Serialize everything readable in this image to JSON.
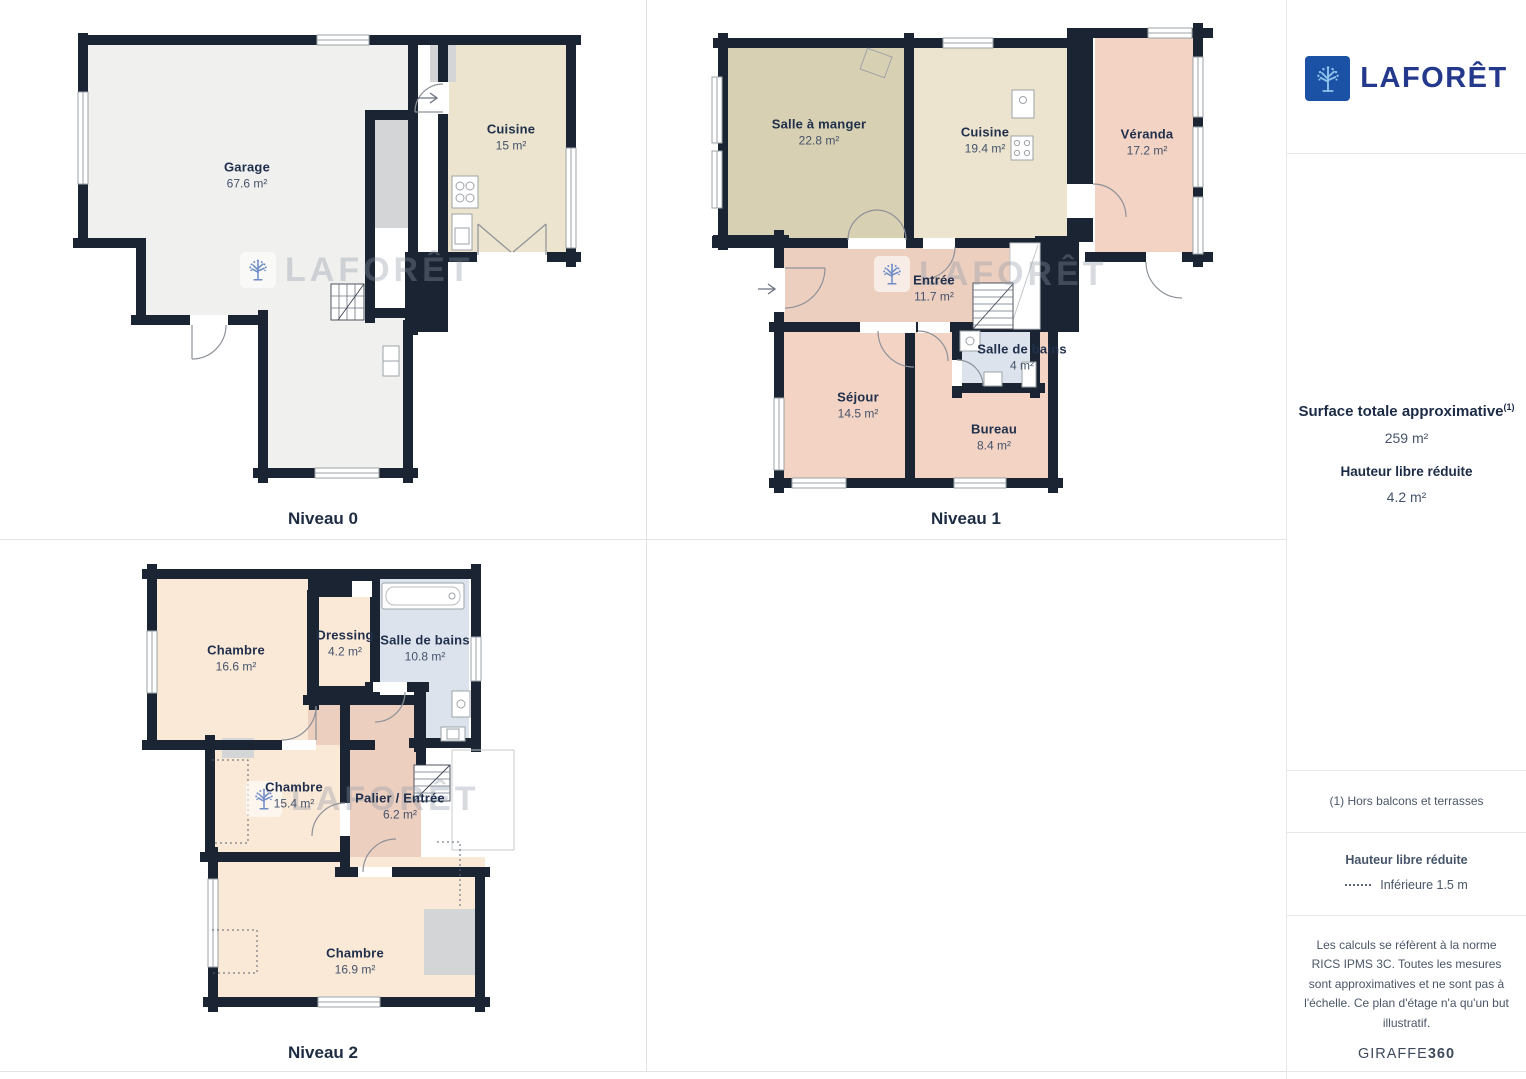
{
  "brand": {
    "name": "LAFORÊT"
  },
  "watermark": {
    "text": "LAFORÊT"
  },
  "levels": [
    {
      "name": "Niveau 0",
      "rooms": [
        {
          "label": "Garage",
          "area": "67.6 m²"
        },
        {
          "label": "Cuisine",
          "area": "15 m²"
        }
      ]
    },
    {
      "name": "Niveau 1",
      "rooms": [
        {
          "label": "Salle à manger",
          "area": "22.8 m²"
        },
        {
          "label": "Cuisine",
          "area": "19.4 m²"
        },
        {
          "label": "Véranda",
          "area": "17.2 m²"
        },
        {
          "label": "Entrée",
          "area": "11.7 m²"
        },
        {
          "label": "Salle de bains",
          "area": "4 m²"
        },
        {
          "label": "Séjour",
          "area": "14.5 m²"
        },
        {
          "label": "Bureau",
          "area": "8.4 m²"
        }
      ]
    },
    {
      "name": "Niveau 2",
      "rooms": [
        {
          "label": "Chambre",
          "area": "16.6 m²"
        },
        {
          "label": "Dressing",
          "area": "4.2 m²"
        },
        {
          "label": "Salle de bains",
          "area": "10.8 m²"
        },
        {
          "label": "Chambre",
          "area": "15.4 m²"
        },
        {
          "label": "Palier / Entrée",
          "area": "6.2 m²"
        },
        {
          "label": "Chambre",
          "area": "16.9 m²"
        }
      ]
    }
  ],
  "sidebar": {
    "surface_title": "Surface totale approximative",
    "surface_note_ref": "(1)",
    "surface_value": "259 m²",
    "reduced_height_title": "Hauteur libre réduite",
    "reduced_height_value": "4.2 m²",
    "footnote": "(1) Hors balcons et terrasses",
    "legend_title": "Hauteur libre réduite",
    "legend_item": "Inférieure 1.5 m",
    "disclaimer": "Les calculs se réfèrent à la norme RICS IPMS 3C. Toutes les mesures sont approximatives et ne sont pas à l'échelle. Ce plan d'étage n'a qu'un but illustratif.",
    "credit_brand": "GIRAFFE",
    "credit_suffix": "360"
  },
  "colors": {
    "wall": "#1b2433",
    "garage": "#f0f0ee",
    "kitchen": "#ece4ce",
    "dining": "#d8d0b2",
    "veranda": "#f3d3c3",
    "hall": "#edcfc0",
    "bathroom": "#dce3ed",
    "bedroom": "#fbe9d8",
    "closet": "#d3d5d7",
    "brand_square": "#1b52a5",
    "brand_text": "#24388c"
  }
}
